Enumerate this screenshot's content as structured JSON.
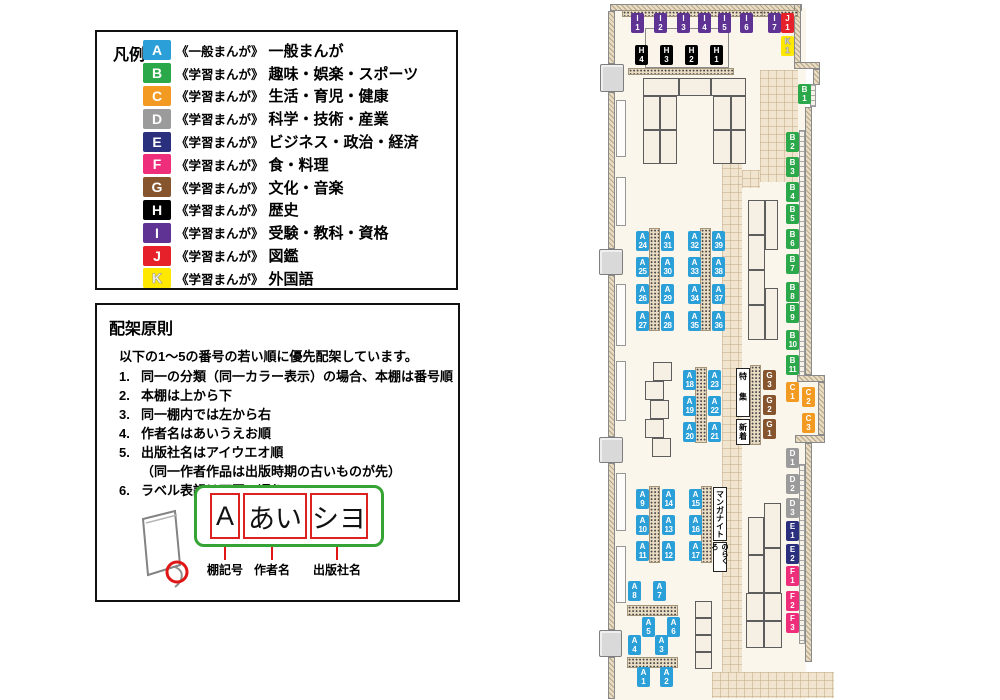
{
  "legend": {
    "title": "凡例",
    "items": [
      {
        "code": "A",
        "series": "《一般まんが》",
        "label": "一般まんが",
        "color": "#2b9fd8"
      },
      {
        "code": "B",
        "series": "《学習まんが》",
        "label": "趣味・娯楽・スポーツ",
        "color": "#2ba94a"
      },
      {
        "code": "C",
        "series": "《学習まんが》",
        "label": "生活・育児・健康",
        "color": "#f29a22"
      },
      {
        "code": "D",
        "series": "《学習まんが》",
        "label": "科学・技術・産業",
        "color": "#9b9b9b"
      },
      {
        "code": "E",
        "series": "《学習まんが》",
        "label": "ビジネス・政治・経済",
        "color": "#2a2f7e"
      },
      {
        "code": "F",
        "series": "《学習まんが》",
        "label": "食・料理",
        "color": "#ee2d7b"
      },
      {
        "code": "G",
        "series": "《学習まんが》",
        "label": "文化・音楽",
        "color": "#86552d"
      },
      {
        "code": "H",
        "series": "《学習まんが》",
        "label": "歴史",
        "color": "#000000"
      },
      {
        "code": "I",
        "series": "《学習まんが》",
        "label": "受験・教科・資格",
        "color": "#5f3393"
      },
      {
        "code": "J",
        "series": "《学習まんが》",
        "label": "図鑑",
        "color": "#e62129"
      },
      {
        "code": "K",
        "series": "《学習まんが》",
        "label": "外国語",
        "color": "#ffe800"
      }
    ]
  },
  "principles": {
    "title": "配架原則",
    "intro": "以下の1～5の番号の若い順に優先配架しています。",
    "rules": [
      "同一の分類（同一カラー表示）の場合、本棚は番号順",
      "本棚は上から下",
      "同一棚内では左から右",
      "作者名はあいうえお順",
      "出版社名はアイウエオ順",
      "ラベル表記は下図の通り"
    ],
    "rule5_note": "（同一作者作品は出版時期の古いものが先）",
    "label_example": {
      "parts": [
        {
          "text": "A",
          "caption": "棚記号"
        },
        {
          "text": "あい",
          "caption": "作者名"
        },
        {
          "text": "シヨ",
          "caption": "出版社名"
        }
      ]
    }
  },
  "colors": {
    "A": "#2b9fd8",
    "B": "#2ba94a",
    "C": "#f29a22",
    "D": "#9b9b9b",
    "E": "#2a2f7e",
    "F": "#ee2d7b",
    "G": "#86552d",
    "H": "#000000",
    "I": "#5f3393",
    "J": "#e62129",
    "K": "#ffe800"
  },
  "map": {
    "labels": [
      {
        "t": "I",
        "n": "1",
        "x": 71,
        "y": 13
      },
      {
        "t": "I",
        "n": "2",
        "x": 94,
        "y": 13
      },
      {
        "t": "I",
        "n": "3",
        "x": 117,
        "y": 13
      },
      {
        "t": "I",
        "n": "4",
        "x": 138,
        "y": 13
      },
      {
        "t": "I",
        "n": "5",
        "x": 158,
        "y": 13
      },
      {
        "t": "I",
        "n": "6",
        "x": 180,
        "y": 13
      },
      {
        "t": "I",
        "n": "7",
        "x": 208,
        "y": 13
      },
      {
        "t": "J",
        "n": "1",
        "x": 221,
        "y": 13
      },
      {
        "t": "K",
        "n": "1",
        "x": 221,
        "y": 36
      },
      {
        "t": "H",
        "n": "4",
        "x": 75,
        "y": 45
      },
      {
        "t": "H",
        "n": "3",
        "x": 100,
        "y": 45
      },
      {
        "t": "H",
        "n": "2",
        "x": 125,
        "y": 45
      },
      {
        "t": "H",
        "n": "1",
        "x": 150,
        "y": 45
      },
      {
        "t": "B",
        "n": "1",
        "x": 238,
        "y": 84
      },
      {
        "t": "B",
        "n": "2",
        "x": 226,
        "y": 132
      },
      {
        "t": "B",
        "n": "3",
        "x": 226,
        "y": 157
      },
      {
        "t": "B",
        "n": "4",
        "x": 226,
        "y": 182
      },
      {
        "t": "B",
        "n": "5",
        "x": 226,
        "y": 204
      },
      {
        "t": "B",
        "n": "6",
        "x": 226,
        "y": 229
      },
      {
        "t": "B",
        "n": "7",
        "x": 226,
        "y": 254
      },
      {
        "t": "B",
        "n": "8",
        "x": 226,
        "y": 282
      },
      {
        "t": "B",
        "n": "9",
        "x": 226,
        "y": 303
      },
      {
        "t": "B",
        "n": "10",
        "x": 226,
        "y": 330
      },
      {
        "t": "B",
        "n": "11",
        "x": 226,
        "y": 355
      },
      {
        "t": "C",
        "n": "1",
        "x": 226,
        "y": 382
      },
      {
        "t": "C",
        "n": "2",
        "x": 242,
        "y": 387
      },
      {
        "t": "C",
        "n": "3",
        "x": 242,
        "y": 413
      },
      {
        "t": "D",
        "n": "1",
        "x": 226,
        "y": 448
      },
      {
        "t": "D",
        "n": "2",
        "x": 226,
        "y": 474
      },
      {
        "t": "D",
        "n": "3",
        "x": 226,
        "y": 498
      },
      {
        "t": "E",
        "n": "1",
        "x": 226,
        "y": 521
      },
      {
        "t": "E",
        "n": "2",
        "x": 226,
        "y": 544
      },
      {
        "t": "F",
        "n": "1",
        "x": 226,
        "y": 566
      },
      {
        "t": "F",
        "n": "2",
        "x": 226,
        "y": 591
      },
      {
        "t": "F",
        "n": "3",
        "x": 226,
        "y": 613
      },
      {
        "t": "G",
        "n": "3",
        "x": 203,
        "y": 370
      },
      {
        "t": "G",
        "n": "2",
        "x": 203,
        "y": 395
      },
      {
        "t": "G",
        "n": "1",
        "x": 203,
        "y": 419
      },
      {
        "t": "A",
        "n": "24",
        "x": 76,
        "y": 231
      },
      {
        "t": "A",
        "n": "25",
        "x": 76,
        "y": 257
      },
      {
        "t": "A",
        "n": "26",
        "x": 76,
        "y": 284
      },
      {
        "t": "A",
        "n": "27",
        "x": 76,
        "y": 311
      },
      {
        "t": "A",
        "n": "31",
        "x": 101,
        "y": 231
      },
      {
        "t": "A",
        "n": "30",
        "x": 101,
        "y": 257
      },
      {
        "t": "A",
        "n": "29",
        "x": 101,
        "y": 284
      },
      {
        "t": "A",
        "n": "28",
        "x": 101,
        "y": 311
      },
      {
        "t": "A",
        "n": "32",
        "x": 128,
        "y": 231
      },
      {
        "t": "A",
        "n": "33",
        "x": 128,
        "y": 257
      },
      {
        "t": "A",
        "n": "34",
        "x": 128,
        "y": 284
      },
      {
        "t": "A",
        "n": "35",
        "x": 128,
        "y": 311
      },
      {
        "t": "A",
        "n": "39",
        "x": 152,
        "y": 231
      },
      {
        "t": "A",
        "n": "38",
        "x": 152,
        "y": 257
      },
      {
        "t": "A",
        "n": "37",
        "x": 152,
        "y": 284
      },
      {
        "t": "A",
        "n": "36",
        "x": 152,
        "y": 311
      },
      {
        "t": "A",
        "n": "18",
        "x": 123,
        "y": 370
      },
      {
        "t": "A",
        "n": "19",
        "x": 123,
        "y": 396
      },
      {
        "t": "A",
        "n": "20",
        "x": 123,
        "y": 422
      },
      {
        "t": "A",
        "n": "23",
        "x": 148,
        "y": 370
      },
      {
        "t": "A",
        "n": "22",
        "x": 148,
        "y": 396
      },
      {
        "t": "A",
        "n": "21",
        "x": 148,
        "y": 422
      },
      {
        "t": "A",
        "n": "9",
        "x": 76,
        "y": 489
      },
      {
        "t": "A",
        "n": "10",
        "x": 76,
        "y": 515
      },
      {
        "t": "A",
        "n": "11",
        "x": 76,
        "y": 541
      },
      {
        "t": "A",
        "n": "14",
        "x": 102,
        "y": 489
      },
      {
        "t": "A",
        "n": "13",
        "x": 102,
        "y": 515
      },
      {
        "t": "A",
        "n": "12",
        "x": 102,
        "y": 541
      },
      {
        "t": "A",
        "n": "15",
        "x": 129,
        "y": 489
      },
      {
        "t": "A",
        "n": "16",
        "x": 129,
        "y": 515
      },
      {
        "t": "A",
        "n": "17",
        "x": 129,
        "y": 541
      },
      {
        "t": "A",
        "n": "8",
        "x": 68,
        "y": 581
      },
      {
        "t": "A",
        "n": "7",
        "x": 93,
        "y": 581
      },
      {
        "t": "A",
        "n": "5",
        "x": 82,
        "y": 617
      },
      {
        "t": "A",
        "n": "6",
        "x": 107,
        "y": 617
      },
      {
        "t": "A",
        "n": "4",
        "x": 68,
        "y": 635
      },
      {
        "t": "A",
        "n": "3",
        "x": 95,
        "y": 635
      },
      {
        "t": "A",
        "n": "1",
        "x": 77,
        "y": 667
      },
      {
        "t": "A",
        "n": "2",
        "x": 100,
        "y": 667
      }
    ],
    "areas": [
      {
        "text": "特集",
        "x": 176,
        "y": 368,
        "w": 14,
        "h": 49
      },
      {
        "text": "新着",
        "x": 176,
        "y": 419,
        "w": 14,
        "h": 26
      },
      {
        "text": "マンガナイト",
        "x": 153,
        "y": 487,
        "w": 14,
        "h": 54
      },
      {
        "text": "のらくろ",
        "x": 153,
        "y": 542,
        "w": 14,
        "h": 30
      }
    ]
  }
}
